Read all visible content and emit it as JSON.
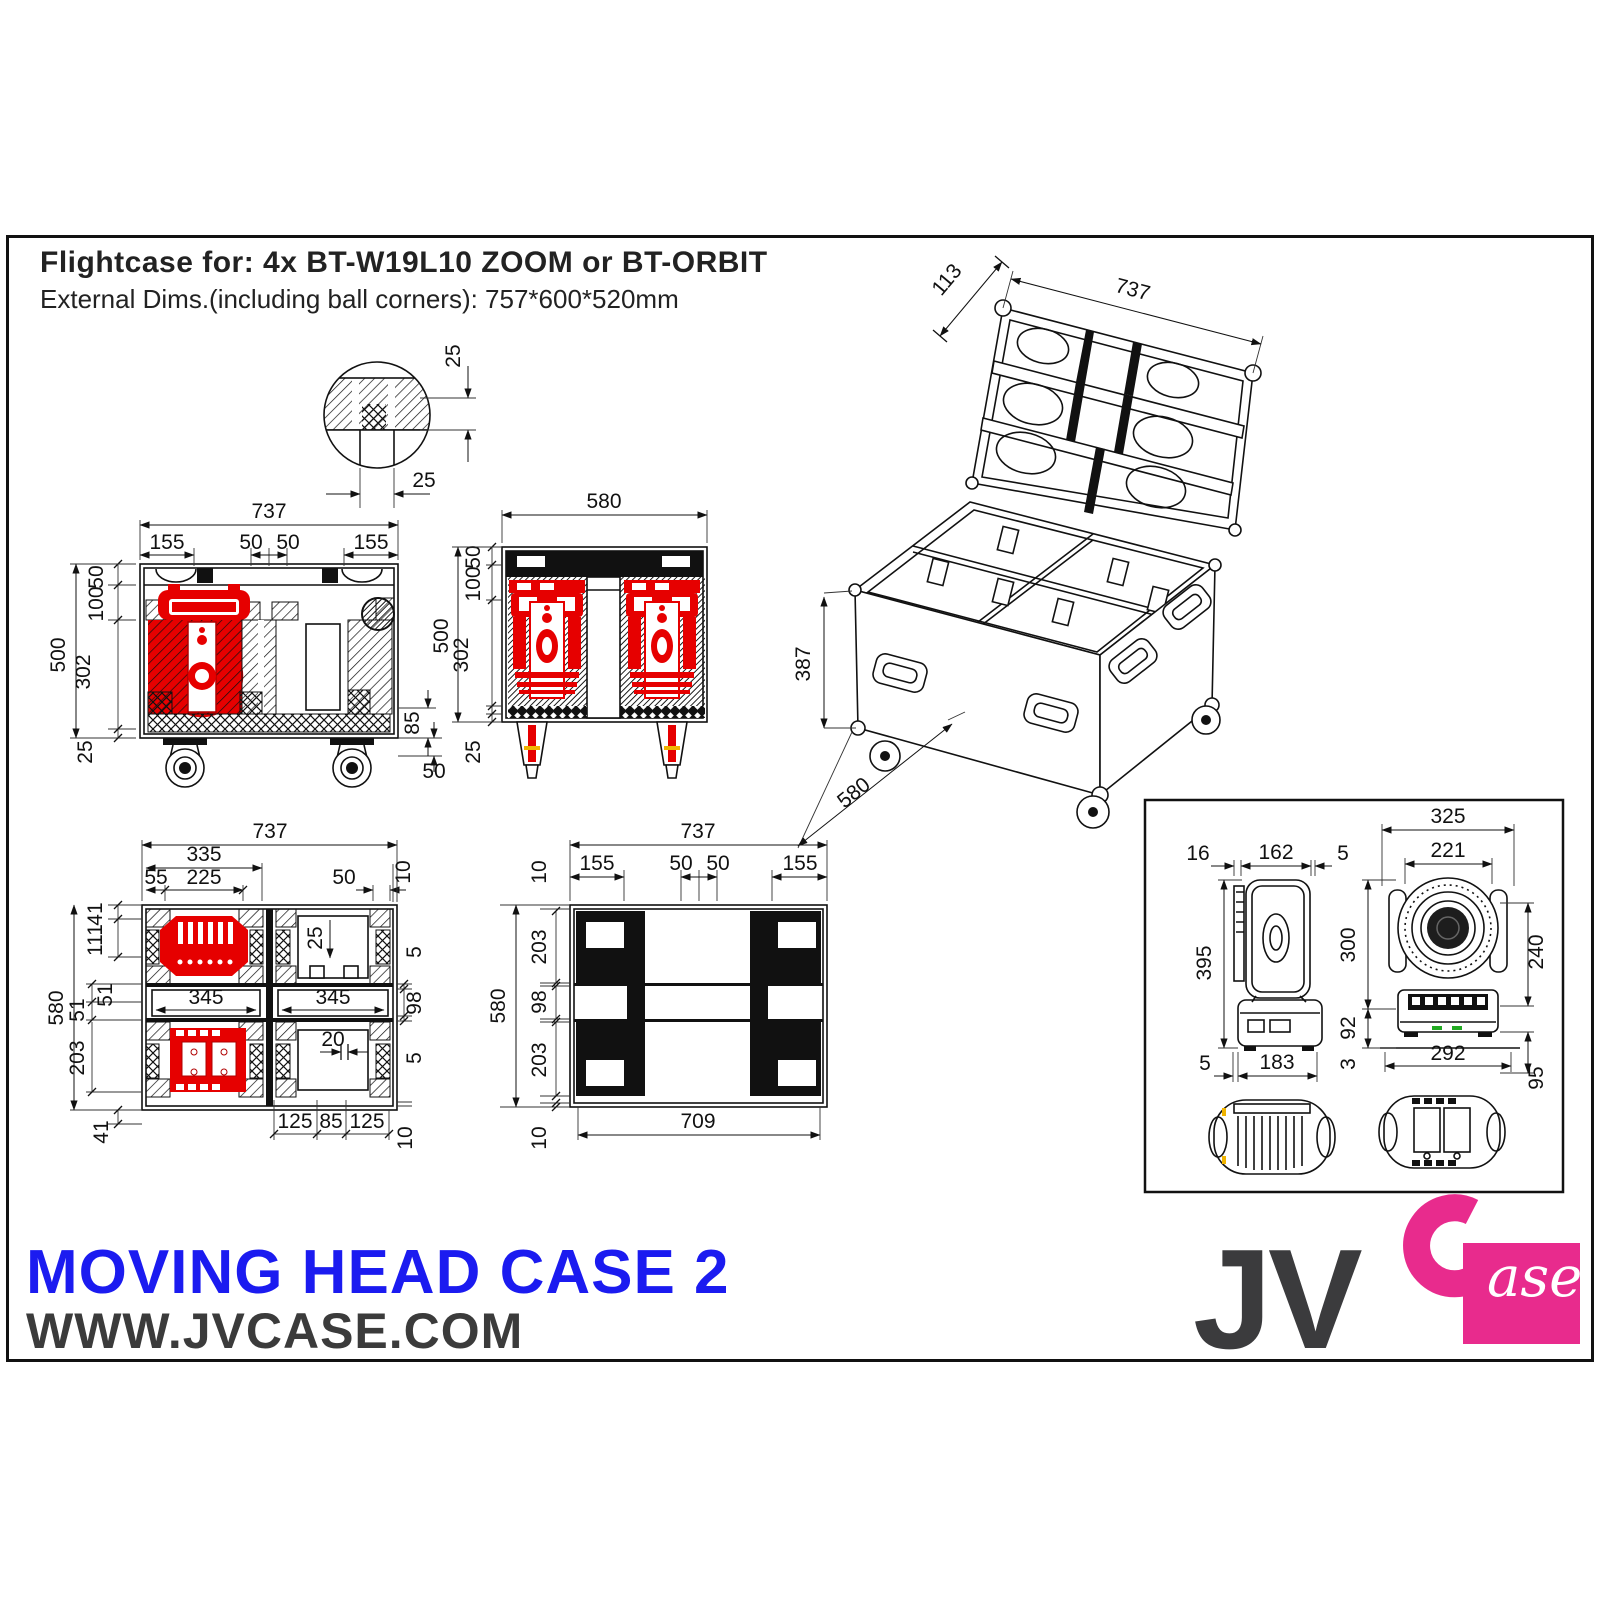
{
  "header": {
    "title": "Flightcase for:  4x BT-W19L10 ZOOM   or   BT-ORBIT",
    "subtitle": "External Dims.(including ball corners): 757*600*520mm"
  },
  "footer": {
    "product": "MOVING HEAD CASE 2",
    "website": "WWW.JVCASE.COM"
  },
  "logo": {
    "jv": "JV",
    "ase": "ase"
  },
  "colors": {
    "fixture_red": "#e60000",
    "title_blue": "#1b1bf0",
    "brand_pink": "#e82b8d",
    "brand_dark": "#3b3b3d",
    "line": "#111111"
  },
  "views": {
    "detail": {
      "dims": [
        "25",
        "25"
      ]
    },
    "front": {
      "dims": [
        "737",
        "155",
        "50",
        "50",
        "155",
        "50",
        "100",
        "302",
        "25",
        "500",
        "85",
        "50"
      ]
    },
    "side": {
      "dims": [
        "580",
        "50",
        "100",
        "302",
        "25",
        "500"
      ]
    },
    "perspective": {
      "dims": [
        "113",
        "737",
        "580",
        "387"
      ]
    },
    "plan": {
      "dims": [
        "737",
        "335",
        "55",
        "225",
        "50",
        "10",
        "41",
        "111",
        "51",
        "51",
        "203",
        "41",
        "580",
        "5",
        "98",
        "5",
        "10",
        "345",
        "345",
        "25",
        "20",
        "125",
        "85",
        "125"
      ]
    },
    "bottom": {
      "dims": [
        "737",
        "155",
        "50",
        "50",
        "155",
        "10",
        "203",
        "98",
        "203",
        "10",
        "580",
        "709"
      ]
    },
    "fixture": {
      "side_dims": [
        "16",
        "162",
        "5",
        "395",
        "5",
        "183"
      ],
      "front_dims": [
        "325",
        "221",
        "300",
        "92",
        "3",
        "240",
        "95",
        "292"
      ]
    }
  }
}
